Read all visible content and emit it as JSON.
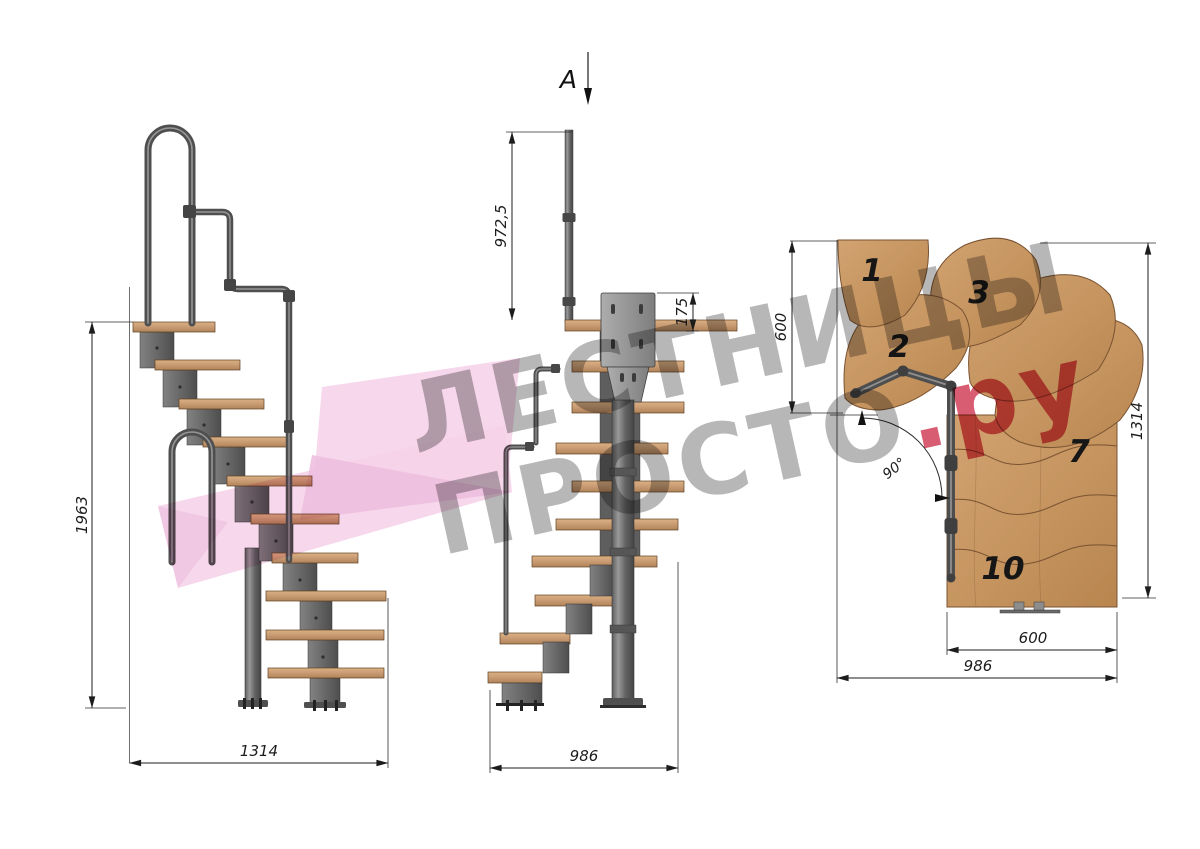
{
  "section_cut": {
    "label": "A"
  },
  "dimensions": {
    "side_height": "1963",
    "side_width": "1314",
    "front_rail_height": "972,5",
    "front_plate": "175",
    "front_width": "986",
    "plan_depth": "600",
    "plan_total_height": "1314",
    "plan_tread_width": "600",
    "plan_total_width": "986",
    "plan_angle": "90°"
  },
  "plan_tread_numbers": {
    "t1": "1",
    "t2": "2",
    "t3": "3",
    "t7": "7",
    "t10": "10"
  },
  "watermark": {
    "line1": "ЛЕСТНИЦЫ",
    "line2_main": "ПРОСТО",
    "line2_accent": ".ру"
  },
  "colors": {
    "wood": "#c89b72",
    "wood_outline": "#7a5332",
    "metal": "#6e6e6e",
    "dimension_line": "#1c1c1c",
    "watermark_gray": "#b7b7b7",
    "accent_pink": "#d95d72",
    "logo_pink": "#f4cfe7"
  }
}
